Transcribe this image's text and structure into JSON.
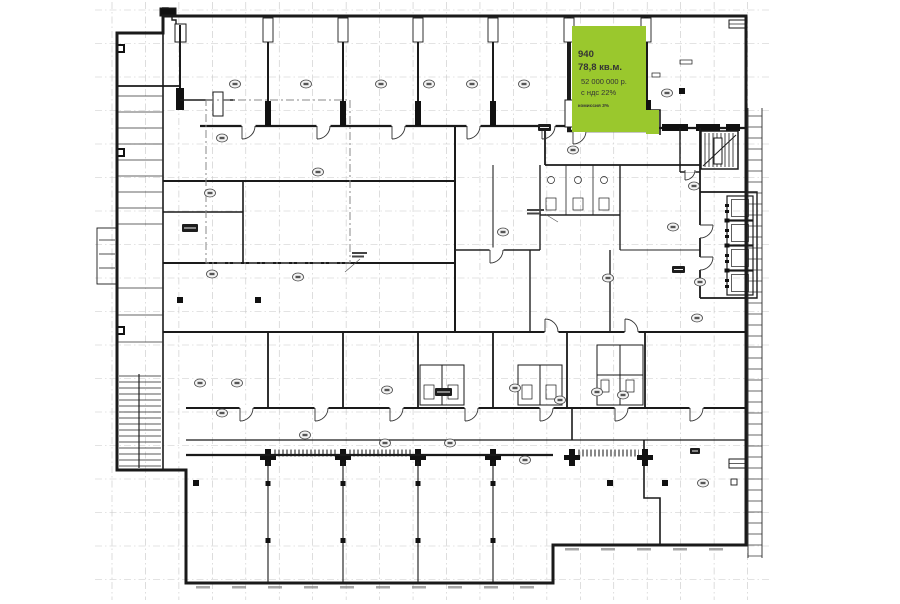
{
  "unit": {
    "id": "940",
    "area": "78,8 кв.м.",
    "price": "52 000 000 р.",
    "vat": "с ндс 22%",
    "commission": "комиссия 3%",
    "highlight_color": "#9ac82d",
    "text_color": "#343434"
  },
  "plan": {
    "wall_color": "#1a1a1a",
    "grid_color": "#c7c7c7",
    "badge_fill": "#f4f4f4",
    "badge_stroke": "#444444",
    "room_badges": [
      [
        235,
        84
      ],
      [
        306,
        84
      ],
      [
        381,
        84
      ],
      [
        429,
        84
      ],
      [
        472,
        84
      ],
      [
        524,
        84
      ],
      [
        667,
        93
      ],
      [
        222,
        138
      ],
      [
        318,
        172
      ],
      [
        210,
        193
      ],
      [
        573,
        150
      ],
      [
        694,
        186
      ],
      [
        212,
        274
      ],
      [
        298,
        277
      ],
      [
        503,
        232
      ],
      [
        608,
        278
      ],
      [
        700,
        282
      ],
      [
        673,
        227
      ],
      [
        697,
        318
      ],
      [
        560,
        400
      ],
      [
        597,
        392
      ],
      [
        623,
        395
      ],
      [
        200,
        383
      ],
      [
        237,
        383
      ],
      [
        387,
        390
      ],
      [
        515,
        388
      ],
      [
        305,
        435
      ],
      [
        385,
        443
      ],
      [
        450,
        443
      ],
      [
        222,
        413
      ],
      [
        525,
        460
      ],
      [
        703,
        483
      ]
    ],
    "column_markers": [
      [
        180,
        300
      ],
      [
        258,
        300
      ],
      [
        196,
        483
      ],
      [
        610,
        483
      ],
      [
        665,
        483
      ],
      [
        682,
        91
      ]
    ]
  }
}
